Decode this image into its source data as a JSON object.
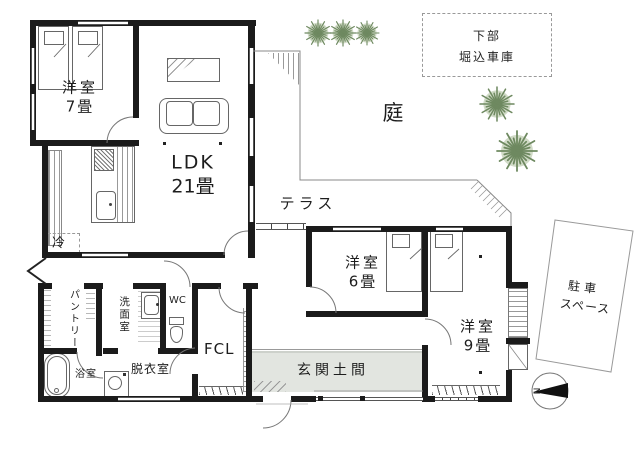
{
  "rooms": {
    "bedroom7": {
      "label": "洋室",
      "size": "7畳"
    },
    "ldk": {
      "label": "LDK",
      "size": "21畳"
    },
    "bedroom6": {
      "label": "洋室",
      "size": "6畳"
    },
    "bedroom9": {
      "label": "洋室",
      "size": "9畳"
    },
    "pantry": {
      "label": "パントリー"
    },
    "washroom": {
      "label": "洗面室"
    },
    "wc": {
      "label": "WC"
    },
    "fcl": {
      "label": "FCL"
    },
    "dressing": {
      "label": "脱衣室"
    },
    "bathroom": {
      "label": "浴室"
    },
    "refrigerator": {
      "label": "冷"
    },
    "entrance": {
      "label": "玄関土間"
    }
  },
  "outdoor": {
    "terrace": {
      "label": "テラス"
    },
    "garden": {
      "label": "庭"
    },
    "garage_note": {
      "line1": "下部",
      "line2": "堀込車庫"
    },
    "parking": {
      "line1": "駐車",
      "line2": "スペース"
    },
    "compass": {
      "north_label": "N"
    }
  },
  "colors": {
    "wall": "#1b1b1b",
    "genkan_fill": "#e2e5e0",
    "tree_stroke": "#6e8960",
    "tree_fill": "#b8c7a9",
    "line": "#888888"
  }
}
